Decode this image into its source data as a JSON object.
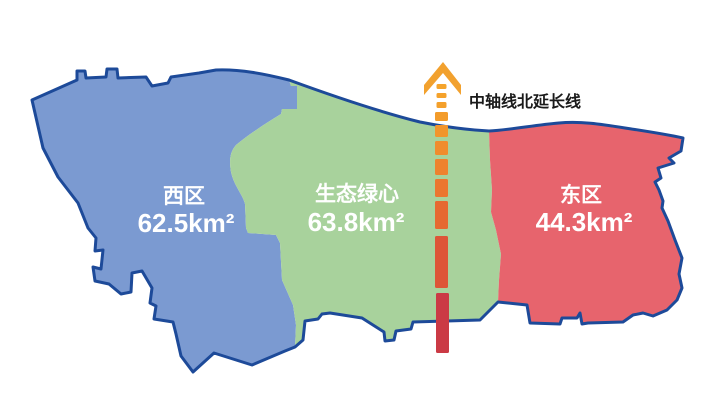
{
  "page": {
    "background": "#ffffff"
  },
  "map": {
    "outline_color": "#1d4a99",
    "regions": [
      {
        "id": "west",
        "name_label": "西区",
        "area_label": "62.5km²",
        "color": "#7b9ad1",
        "label_color": "#ffffff"
      },
      {
        "id": "green-heart",
        "name_label": "生态绿心",
        "area_label": "63.8km²",
        "color": "#a8d29c",
        "label_color": "#ffffff"
      },
      {
        "id": "east",
        "name_label": "东区",
        "area_label": "44.3km²",
        "color": "#e7646d",
        "label_color": "#ffffff"
      }
    ]
  },
  "axis": {
    "label": "中轴线北延长线",
    "label_color": "#1a1a1a",
    "arrow_color": "#f2a12e",
    "dashes": [
      {
        "x": 436.5,
        "y": 84,
        "w": 10,
        "h": 5,
        "color": "#f5a42b"
      },
      {
        "x": 436.5,
        "y": 93,
        "w": 10,
        "h": 5,
        "color": "#f5a22b"
      },
      {
        "x": 436.5,
        "y": 102,
        "w": 10,
        "h": 6,
        "color": "#f4a02b"
      },
      {
        "x": 435,
        "y": 112,
        "w": 13,
        "h": 9,
        "color": "#f39c2b"
      },
      {
        "x": 435,
        "y": 125,
        "w": 13,
        "h": 12,
        "color": "#f2952c"
      },
      {
        "x": 435,
        "y": 141,
        "w": 13,
        "h": 14,
        "color": "#f08c2d"
      },
      {
        "x": 435,
        "y": 159,
        "w": 13,
        "h": 16,
        "color": "#ee822e"
      },
      {
        "x": 435,
        "y": 179,
        "w": 13,
        "h": 18,
        "color": "#eb762f"
      },
      {
        "x": 435,
        "y": 201,
        "w": 13,
        "h": 28,
        "color": "#e66931"
      },
      {
        "x": 435,
        "y": 236,
        "w": 13,
        "h": 52,
        "color": "#dd5537"
      },
      {
        "x": 436,
        "y": 293,
        "w": 13,
        "h": 60,
        "color": "#cb3a45"
      }
    ]
  }
}
